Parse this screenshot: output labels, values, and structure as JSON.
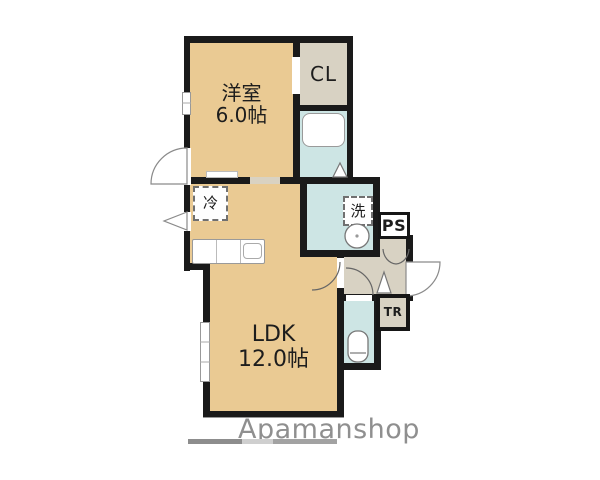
{
  "floorplan": {
    "western_room": {
      "name": "洋室",
      "size": "6.0帖"
    },
    "ldk": {
      "name": "LDK",
      "size": "12.0帖"
    },
    "closet_label": "CL",
    "pipe_space_label": "PS",
    "trunk_label": "TR",
    "refrigerator_label": "冷",
    "washer_label": "洗",
    "watermark": "Apamanshop",
    "colors": {
      "room_tan": "#eaca93",
      "wet_area_blue": "#cde5e4",
      "service_gray": "#d8d2c3",
      "wall_black": "#1a1a1a",
      "watermark_gray": "#8f8f8f"
    }
  }
}
